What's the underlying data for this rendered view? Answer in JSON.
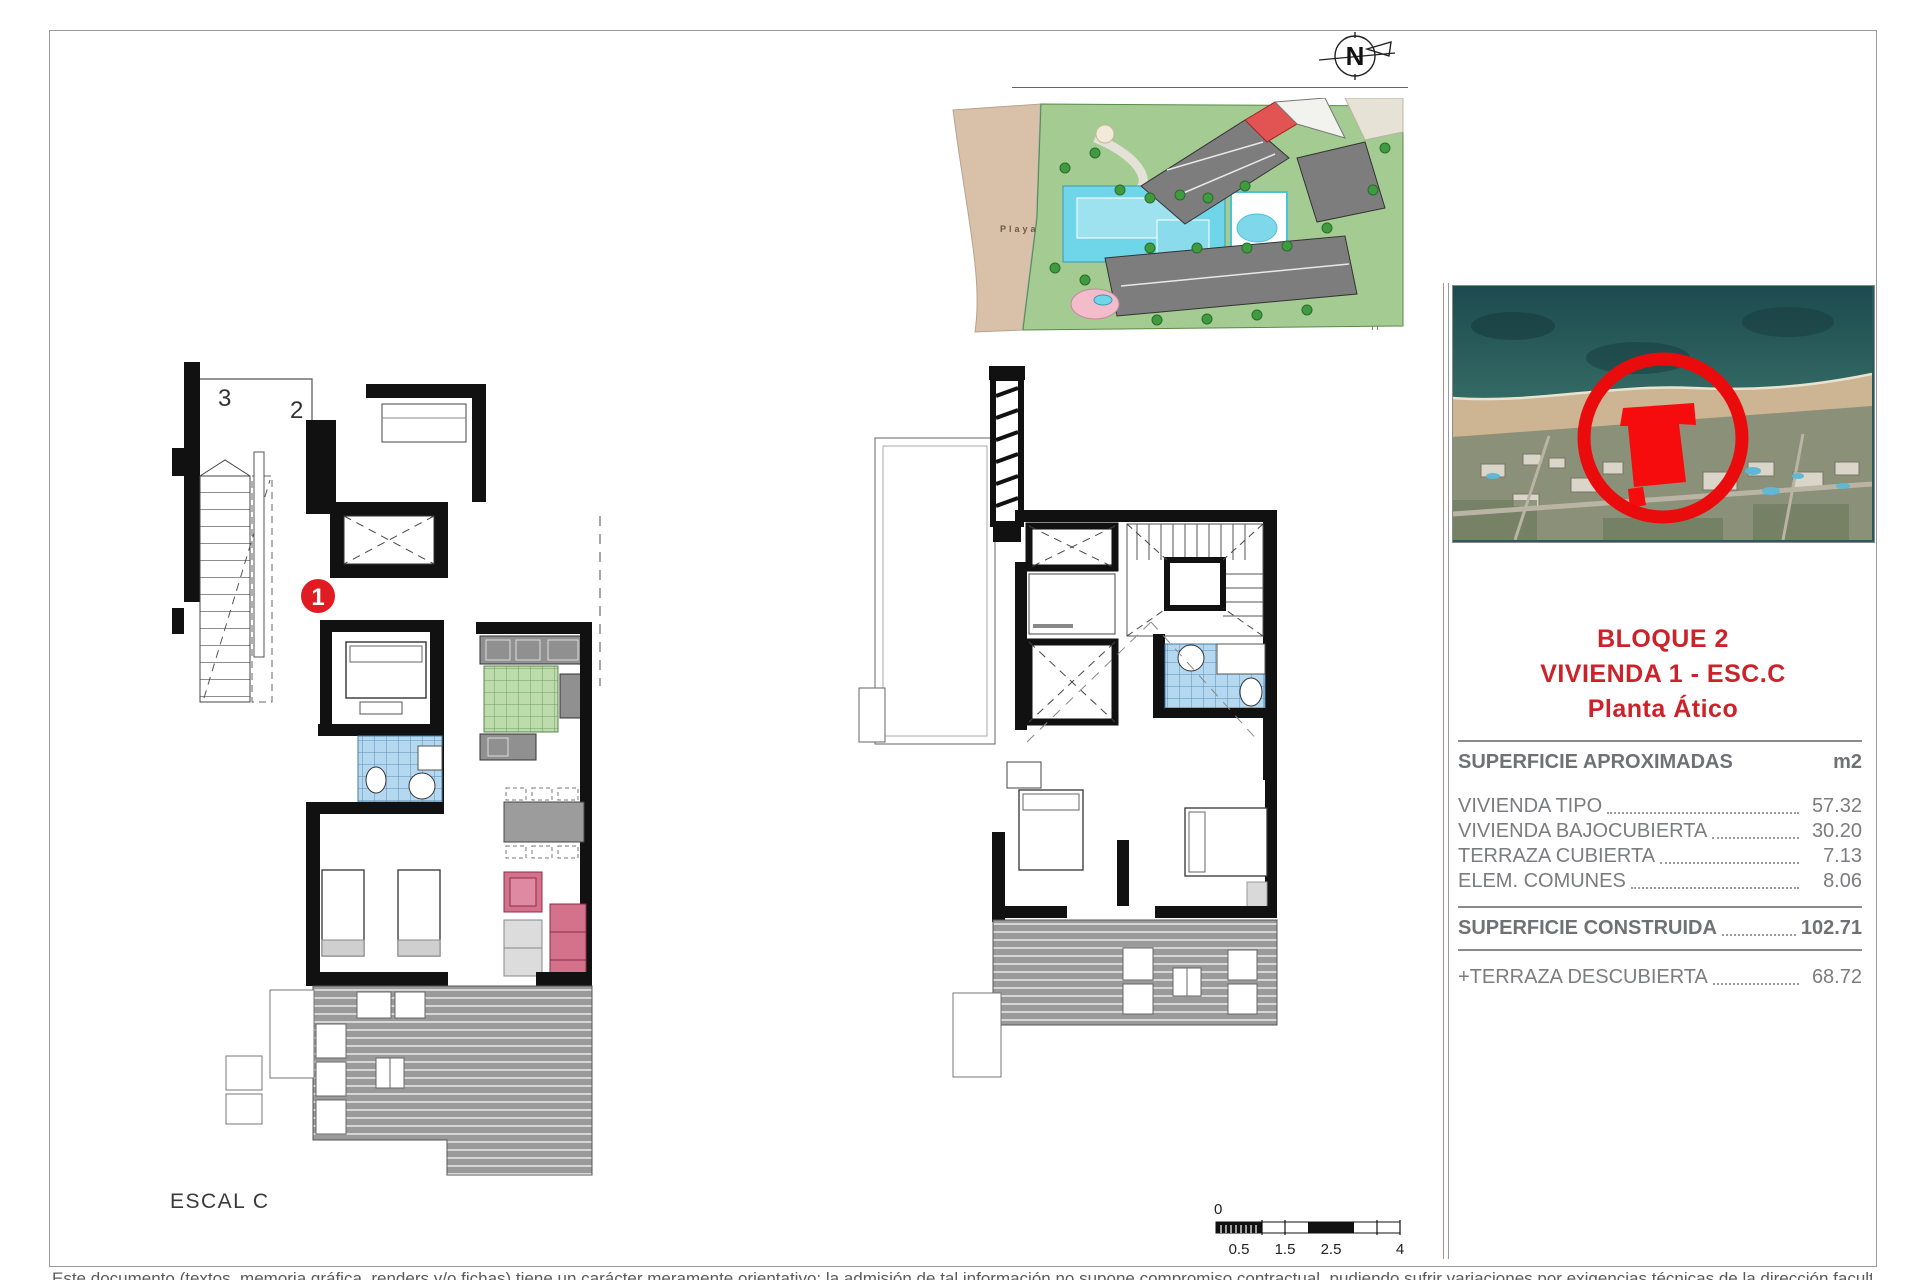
{
  "compass": {
    "label": "N"
  },
  "site_plan": {
    "playa_label": "Playa"
  },
  "location_card": {
    "title_lines": [
      "BLOQUE 2",
      "VIVIENDA 1 - ESC.C",
      "Planta Ático"
    ]
  },
  "areas_table": {
    "header": "SUPERFICIE APROXIMADAS",
    "unit": "m2",
    "rows": [
      {
        "label": "VIVIENDA TIPO",
        "value": "57.32"
      },
      {
        "label": "VIVIENDA BAJOCUBIERTA",
        "value": "30.20"
      },
      {
        "label": "TERRAZA CUBIERTA",
        "value": "7.13"
      },
      {
        "label": "ELEM. COMUNES",
        "value": "8.06"
      }
    ],
    "total": {
      "label": "SUPERFICIE CONSTRUIDA",
      "value": "102.71"
    },
    "extra": {
      "label": "+TERRAZA DESCUBIERTA",
      "value": "68.72"
    }
  },
  "plan_left": {
    "unit_labels": {
      "three": "3",
      "two": "2",
      "one": "1"
    },
    "caption": "ESCAL C"
  },
  "scale_bar": {
    "zero": "0",
    "ticks": [
      "0.5",
      "1.5",
      "2.5",
      "4"
    ]
  },
  "footer": {
    "disclaimer": "Este documento (textos, memoria gráfica, renders y/o fichas) tiene un carácter meramente orientativo; la admisión de tal información no supone compromiso contractual, pudiendo sufrir variaciones por exigencias técnicas de la dirección facultativa o modificación del edificio."
  },
  "colors": {
    "accent_red": "#cc2229",
    "pool_cyan": "#6fd6ea",
    "bath_tile_blue": "#b3d8f0",
    "kitchen_tile_green": "#bcdcab",
    "sofa_pink": "#d4728c",
    "deck_gray": "#9a9a9a",
    "sea_teal": "#2a5a5e",
    "beach_sand": "#d5bda4",
    "garden_green": "#a4cb92",
    "building_gray": "#7d7d7d"
  }
}
